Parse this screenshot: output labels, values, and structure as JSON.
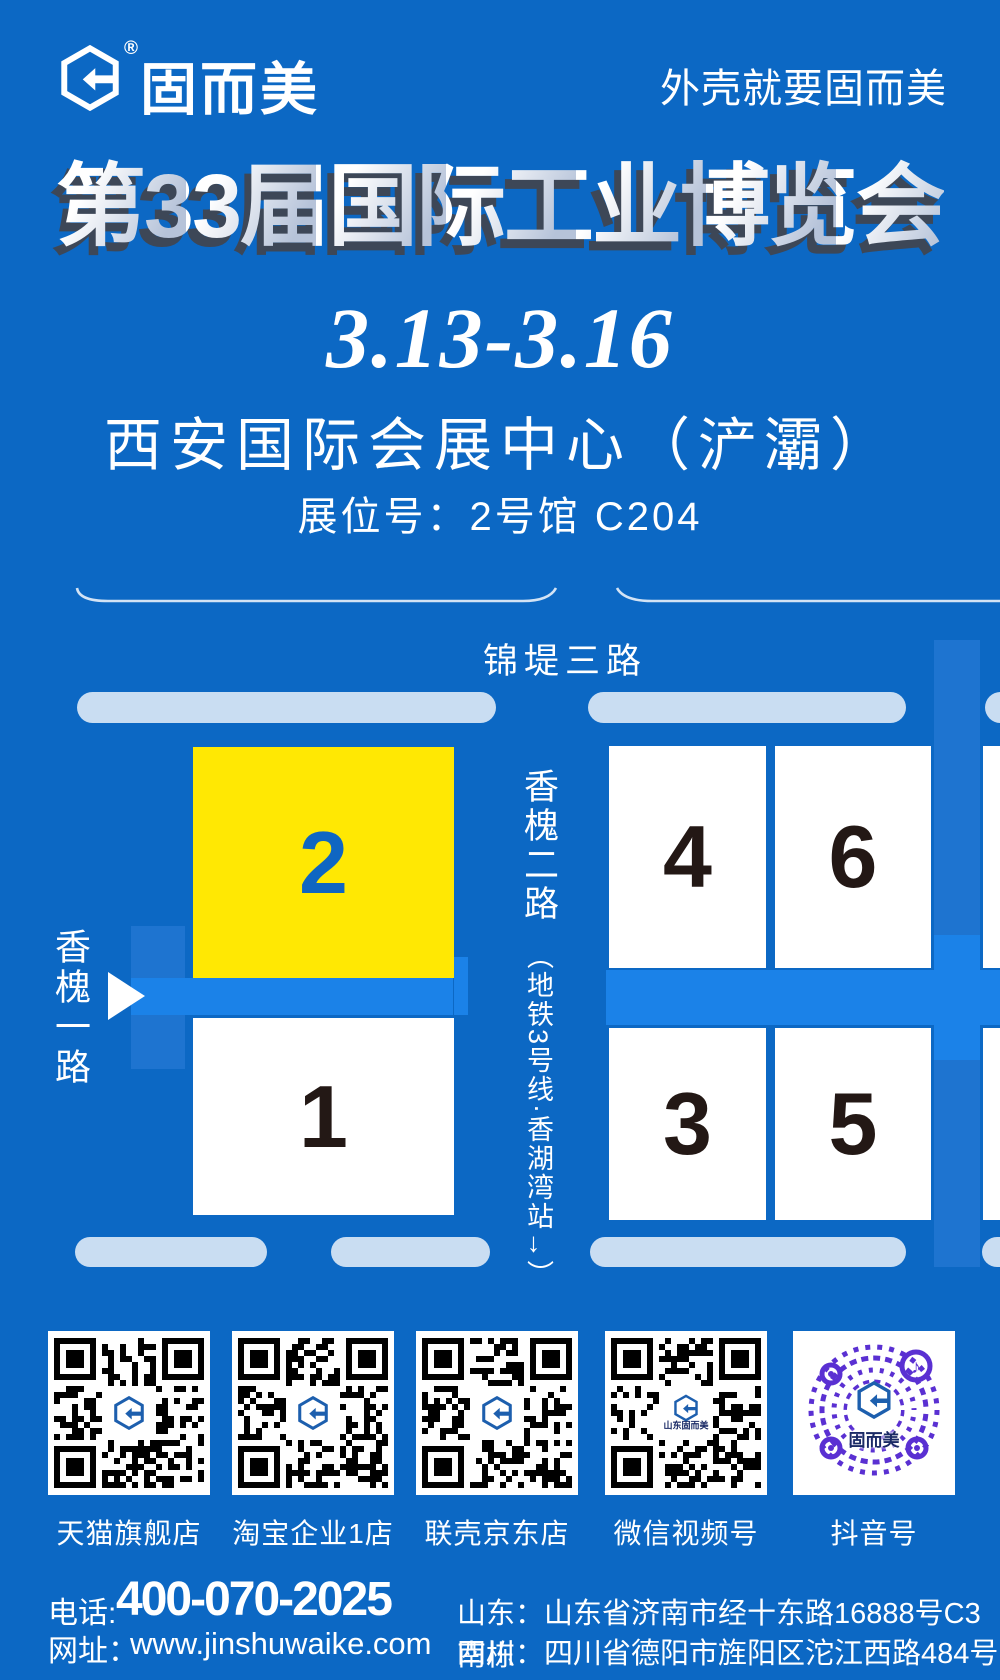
{
  "header": {
    "brand": "固而美",
    "reg": "®",
    "tagline": "外壳就要固而美"
  },
  "hero": {
    "title": "第33届国际工业博览会",
    "dates": "3.13-3.16",
    "venue": "西安国际会展中心（浐灞）",
    "booth": "展位号：2号馆 C204"
  },
  "map": {
    "road_top": "锦堤三路",
    "road_left": "香槐一路",
    "road_mid": "香槐二路",
    "metro": "（地铁3号线·香湖湾站→）",
    "halls": [
      {
        "num": "2",
        "highlight": true
      },
      {
        "num": "1",
        "highlight": false
      },
      {
        "num": "4",
        "highlight": false
      },
      {
        "num": "6",
        "highlight": false
      },
      {
        "num": "3",
        "highlight": false
      },
      {
        "num": "5",
        "highlight": false
      }
    ]
  },
  "qr": [
    {
      "label": "天猫旗舰店",
      "style": "qr",
      "center_text": ""
    },
    {
      "label": "淘宝企业1店",
      "style": "qr",
      "center_text": ""
    },
    {
      "label": "联壳京东店",
      "style": "qr",
      "center_text": ""
    },
    {
      "label": "微信视频号",
      "style": "qr",
      "center_text": "山东固而美"
    },
    {
      "label": "抖音号",
      "style": "dots",
      "center_text": "固而美",
      "note_icon": "♪"
    }
  ],
  "footer": {
    "phone_label": "电话:",
    "phone": "400-070-2025",
    "web_label": "网址：",
    "website": "www.jinshuwaike.com",
    "addr1": "山东：山东省济南市经十东路16888号C3南栋",
    "addr2": "四川：四川省德阳市旌阳区沱江西路484号5栋4号"
  },
  "colors": {
    "bg": "#0c68c4",
    "road": "#1b82e8",
    "roadside": "#1e74d0",
    "bar": "#c9ddf2",
    "yellow": "#ffe803",
    "ink": "#231815",
    "numblue": "#0f66c2",
    "purple": "#5a30d2",
    "logoblue": "#1d5fae",
    "shadow": "#3d4757",
    "grad2": "#b6c3d9"
  }
}
